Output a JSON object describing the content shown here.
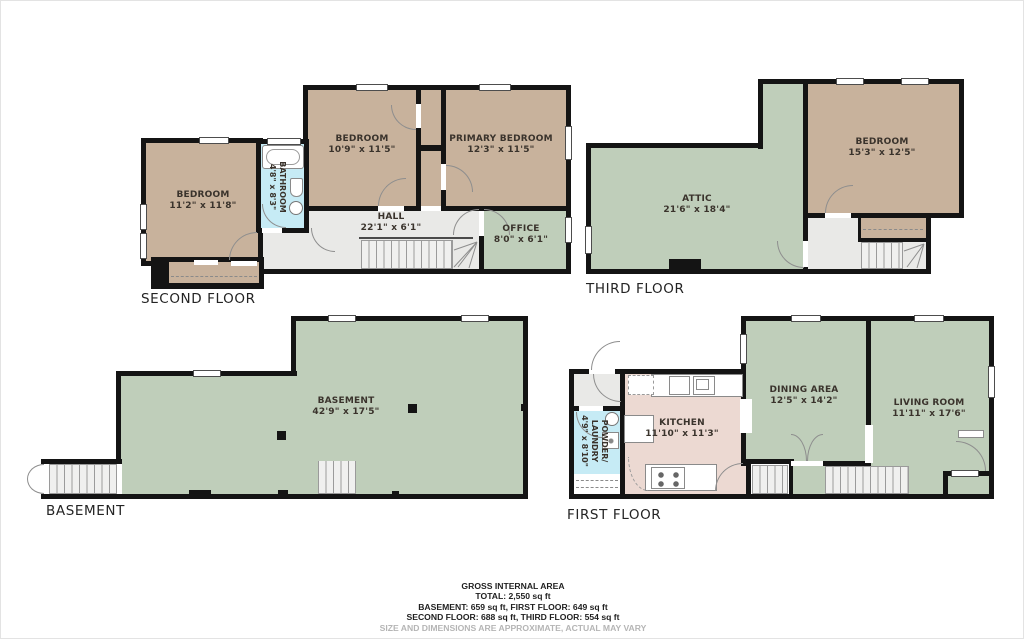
{
  "colors": {
    "wall": "#141414",
    "tan": "#c8b29c",
    "green": "#bfceba",
    "blue": "#c6ebf5",
    "pink": "#ecd9d2",
    "gray": "#e9e9e7",
    "line": "#8e8e8e",
    "label": "#3a332c",
    "footer": "#1f1f1f",
    "footer_muted": "#b5b5b5"
  },
  "floors": {
    "second": {
      "label": "SECOND FLOOR",
      "rooms": {
        "bedroom_left": {
          "name": "BEDROOM",
          "dims": "11'2\" x 11'8\""
        },
        "bathroom": {
          "name": "BATHROOM",
          "dims": "4'8\" x 8'3\""
        },
        "bedroom_middle": {
          "name": "BEDROOM",
          "dims": "10'9\" x 11'5\""
        },
        "primary_bedroom": {
          "name": "PRIMARY BEDROOM",
          "dims": "12'3\" x 11'5\""
        },
        "hall": {
          "name": "HALL",
          "dims": "22'1\" x 6'1\""
        },
        "office": {
          "name": "OFFICE",
          "dims": "8'0\" x 6'1\""
        }
      }
    },
    "third": {
      "label": "THIRD FLOOR",
      "rooms": {
        "attic": {
          "name": "ATTIC",
          "dims": "21'6\" x 18'4\""
        },
        "bedroom": {
          "name": "BEDROOM",
          "dims": "15'3\" x 12'5\""
        }
      }
    },
    "basement": {
      "label": "BASEMENT",
      "rooms": {
        "basement": {
          "name": "BASEMENT",
          "dims": "42'9\" x 17'5\""
        }
      }
    },
    "first": {
      "label": "FIRST FLOOR",
      "rooms": {
        "powder_laundry": {
          "name": "POWDER/ LAUNDRY",
          "dims": "4'9\" x 8'10\""
        },
        "kitchen": {
          "name": "KITCHEN",
          "dims": "11'10\" x 11'3\""
        },
        "dining_area": {
          "name": "DINING AREA",
          "dims": "12'5\" x 14'2\""
        },
        "living_room": {
          "name": "LIVING ROOM",
          "dims": "11'11\" x 17'6\""
        }
      }
    }
  },
  "footer": {
    "title": "GROSS INTERNAL AREA",
    "total": "TOTAL: 2,550 sq ft",
    "line3": "BASEMENT: 659 sq ft, FIRST FLOOR: 649 sq ft",
    "line4": "SECOND FLOOR: 688 sq ft, THIRD FLOOR: 554 sq ft",
    "disclaimer": "SIZE AND DIMENSIONS ARE APPROXIMATE, ACTUAL MAY VARY"
  }
}
